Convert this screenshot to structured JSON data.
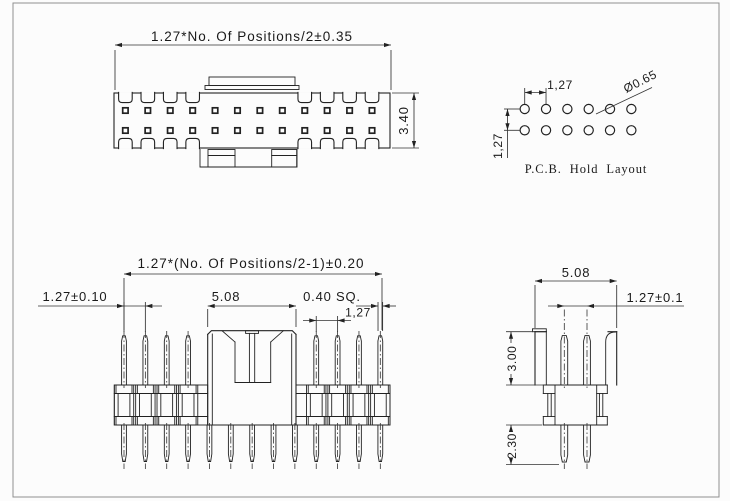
{
  "views": {
    "top_view": {
      "width_label": "1.27*No. Of Positions/2±0.35",
      "height_label": "3.40",
      "positions_per_row": 12,
      "rows": 2
    },
    "pcb_layout": {
      "title": "P.C.B. Hold Layout",
      "pitch_h_label": "1,27",
      "pitch_v_label": "1,27",
      "hole_dia_label": "Ø0.65",
      "rows": 2,
      "cols": 6
    },
    "side_view": {
      "span_label": "1.27*(No. Of Positions/2-1)±0.20",
      "pitch_label": "1.27±0.10",
      "shroud_width_label": "5.08",
      "pin_size_label": "0.40 SQ.",
      "pitch2_label": "1,27",
      "bottom_pins": 13
    },
    "end_view": {
      "width_label": "5.08",
      "pitch_label": "1.27±0.1",
      "pin_top_label": "3.00",
      "pin_bottom_label": "2.30"
    }
  },
  "colors": {
    "line": "#222222",
    "dim": "#333333",
    "border": "#8f8f8f",
    "background": "#fcfcfc"
  }
}
